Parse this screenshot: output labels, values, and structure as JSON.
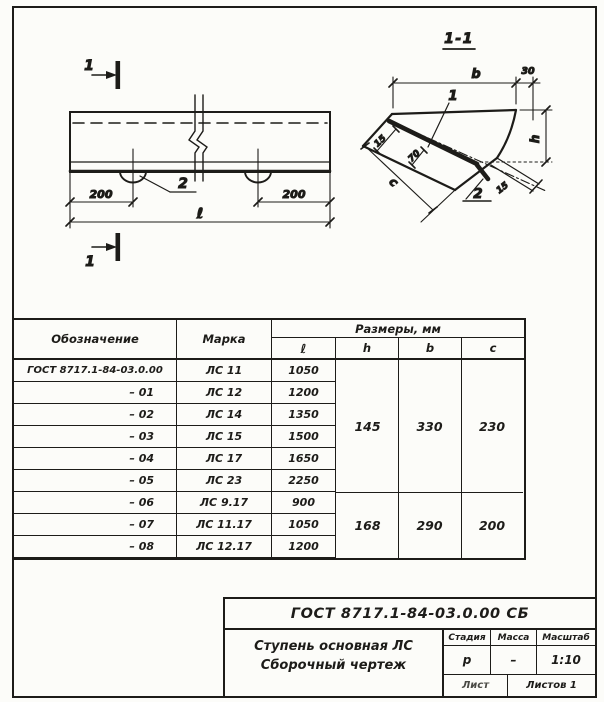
{
  "colors": {
    "ink": "#1d1c19",
    "paper": "#fcfcf9"
  },
  "plan_view": {
    "section_mark_top": "1",
    "section_mark_bottom": "1",
    "dim_left": "200",
    "dim_right": "200",
    "dim_length": "ℓ",
    "callout_loop": "2"
  },
  "section_view": {
    "title": "1-1",
    "dim_b": "b",
    "dim_nose": "30",
    "dim_h": "h",
    "dim_c": "c",
    "dim_edge_top": "15",
    "dim_offset": "70",
    "dim_edge_bottom": "15",
    "callout_insert": "1",
    "callout_plate": "2"
  },
  "table": {
    "headers": {
      "designation": "Обозначение",
      "mark": "Марка",
      "dimensions": "Размеры, мм",
      "sub": [
        "ℓ",
        "h",
        "b",
        "c"
      ]
    },
    "rows": [
      {
        "designation": "ГОСТ 8717.1-84-03.0.00",
        "mark": "ЛС 11",
        "l": "1050"
      },
      {
        "designation": "– 01",
        "mark": "ЛС 12",
        "l": "1200"
      },
      {
        "designation": "– 02",
        "mark": "ЛС 14",
        "l": "1350"
      },
      {
        "designation": "– 03",
        "mark": "ЛС 15",
        "l": "1500"
      },
      {
        "designation": "– 04",
        "mark": "ЛС 17",
        "l": "1650"
      },
      {
        "designation": "– 05",
        "mark": "ЛС 23",
        "l": "2250"
      },
      {
        "designation": "– 06",
        "mark": "ЛС 9.17",
        "l": "900"
      },
      {
        "designation": "– 07",
        "mark": "ЛС 11.17",
        "l": "1050"
      },
      {
        "designation": "– 08",
        "mark": "ЛС 12.17",
        "l": "1200"
      }
    ],
    "merged": {
      "group1": {
        "h": "145",
        "b": "330",
        "c": "230"
      },
      "group2": {
        "h": "168",
        "b": "290",
        "c": "200"
      }
    }
  },
  "title_block": {
    "designation": "ГОСТ 8717.1-84-03.0.00 СБ",
    "name_line1": "Ступень основная ЛС",
    "name_line2": "Сборочный чертеж",
    "stage_label": "Стадия",
    "mass_label": "Масса",
    "scale_label": "Масштаб",
    "stage_value": "р",
    "mass_value": "–",
    "scale_value": "1:10",
    "sheet_label": "Лист",
    "sheets_label": "Листов 1"
  }
}
